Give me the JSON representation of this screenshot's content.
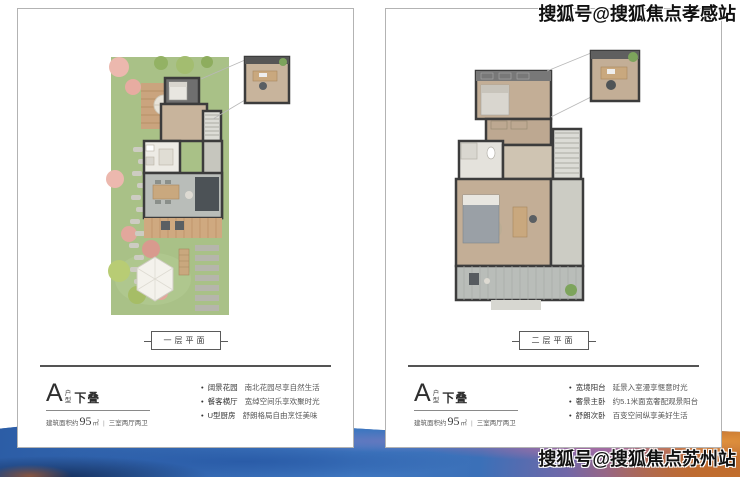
{
  "watermarks": {
    "top": "搜狐号@搜狐焦点孝感站",
    "bottom": "搜狐号@搜狐焦点苏州站"
  },
  "cards": [
    {
      "floor_label": "一层平面",
      "unit_letter": "A",
      "unit_stack": [
        "户",
        "型"
      ],
      "unit_suffix": "下叠",
      "area_prefix": "建筑面积约",
      "area_value": "95",
      "area_unit": "㎡",
      "separator": "|",
      "layout_text": "三室两厅两卫",
      "features": [
        {
          "label": "阔景花园",
          "desc": "南北花园尽享自然生活"
        },
        {
          "label": "餐客横厅",
          "desc": "宽绰空间乐享欢聚时光"
        },
        {
          "label": "U型厨房",
          "desc": "舒朗格局自由烹饪美味"
        }
      ]
    },
    {
      "floor_label": "二层平面",
      "unit_letter": "A",
      "unit_stack": [
        "户",
        "型"
      ],
      "unit_suffix": "下叠",
      "area_prefix": "建筑面积约",
      "area_value": "95",
      "area_unit": "㎡",
      "separator": "|",
      "layout_text": "三室两厅两卫",
      "features": [
        {
          "label": "宽境阳台",
          "desc": "延景入室漫享惬意时光"
        },
        {
          "label": "奢景主卧",
          "desc": "约5.1米面宽奢配观景阳台"
        },
        {
          "label": "舒朗次卧",
          "desc": "百变空间纵享美好生活"
        }
      ]
    }
  ],
  "colors": {
    "card_border": "#b3b3b3",
    "divider": "#545454",
    "text_dark": "#2f2f2f",
    "band_blue": "#3a6fb5",
    "band_navy": "#16315f",
    "band_purple": "#8a64a0",
    "band_orange": "#c97a30",
    "garden_green": "#a9c187",
    "deck_wood": "#caa47e"
  }
}
